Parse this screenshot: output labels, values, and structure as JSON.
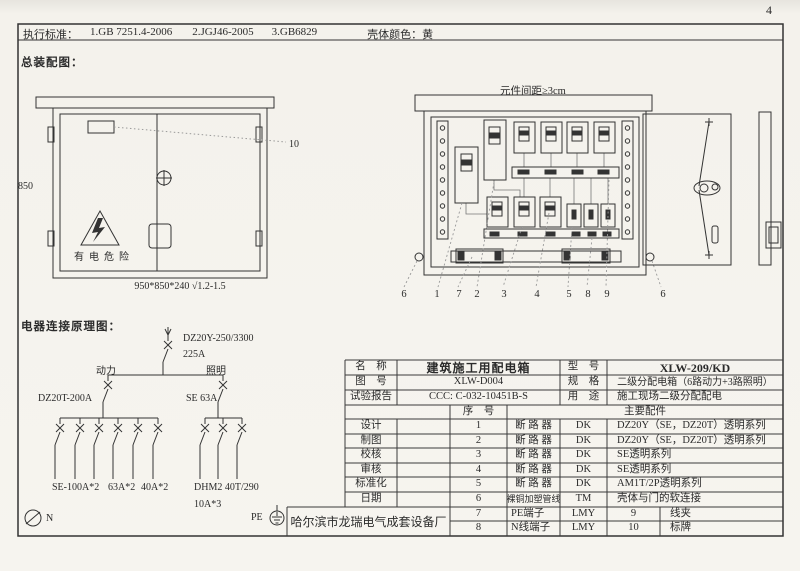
{
  "page": {
    "number": "4"
  },
  "standards_bar": {
    "label": "执行标准：",
    "items": [
      "1.GB 7251.4-2006",
      "2.JGJ46-2005",
      "3.GB6829"
    ],
    "shell_color_label": "壳体颜色：",
    "shell_color_value": "黄"
  },
  "assembly_view": {
    "section_title": "总装配图：",
    "front": {
      "height_dim": "850",
      "size_note": "950*850*240 √1.2-1.5",
      "hazard_text": "有电危险",
      "plate_callout": "10"
    },
    "open": {
      "spacing_note": "元件间距≥3cm",
      "callouts": [
        "6",
        "1",
        "7",
        "2",
        "3",
        "4",
        "5",
        "8",
        "9",
        "6"
      ]
    }
  },
  "schematic": {
    "section_title": "电器连接原理图：",
    "main_breaker_model": "DZ20Y-250/3300",
    "main_breaker_rating": "225A",
    "power_label": "动力",
    "lighting_label": "照明",
    "power_breaker": "DZ20T-200A",
    "lighting_breaker": "SE 63A",
    "power_branches": [
      "SE-100A*2",
      "63A*2",
      "40A*2"
    ],
    "lighting_branch_model": "DHM2 40T/290",
    "lighting_branch_rating": "10A*3",
    "neutral_label": "N",
    "pe_label": "PE"
  },
  "title_block": {
    "name_label": "名　称",
    "name_value": "建筑施工用配电箱",
    "model_label": "型　号",
    "model_value": "XLW-209/KD",
    "drawing_label": "图　号",
    "drawing_value": "XLW-D004",
    "spec_label": "规　格",
    "spec_value": "二级分配电箱（6路动力+3路照明）",
    "report_label": "试验报告",
    "report_value": "CCC: C-032-10451B-S",
    "use_label": "用　途",
    "use_value": "施工现场二级分配配电",
    "seq_header": "序　号",
    "parts_header": "主要配件",
    "sign_labels": [
      "设计",
      "制图",
      "校核",
      "审核",
      "标准化",
      "日期"
    ],
    "rows": [
      {
        "seq": "1",
        "name": "断 路 器",
        "code": "DK",
        "desc": "DZ20Y（SE，DZ20T）透明系列"
      },
      {
        "seq": "2",
        "name": "断 路 器",
        "code": "DK",
        "desc": "DZ20Y（SE，DZ20T）透明系列"
      },
      {
        "seq": "3",
        "name": "断 路 器",
        "code": "DK",
        "desc": "SE透明系列"
      },
      {
        "seq": "4",
        "name": "断 路 器",
        "code": "DK",
        "desc": "SE透明系列"
      },
      {
        "seq": "5",
        "name": "断 路 器",
        "code": "DK",
        "desc": "AM1T/2P透明系列"
      },
      {
        "seq": "6",
        "name": "裸铜加塑管线",
        "code": "TM",
        "desc": "壳体与门的软连接"
      },
      {
        "seq": "7",
        "name": "PE端子",
        "code": "LMY",
        "desc2_seq": "9",
        "desc2_name": "线夹"
      },
      {
        "seq": "8",
        "name": "N线端子",
        "code": "LMY",
        "desc2_seq": "10",
        "desc2_name": "标牌"
      }
    ],
    "factory": "哈尔滨市龙瑞电气成套设备厂"
  }
}
